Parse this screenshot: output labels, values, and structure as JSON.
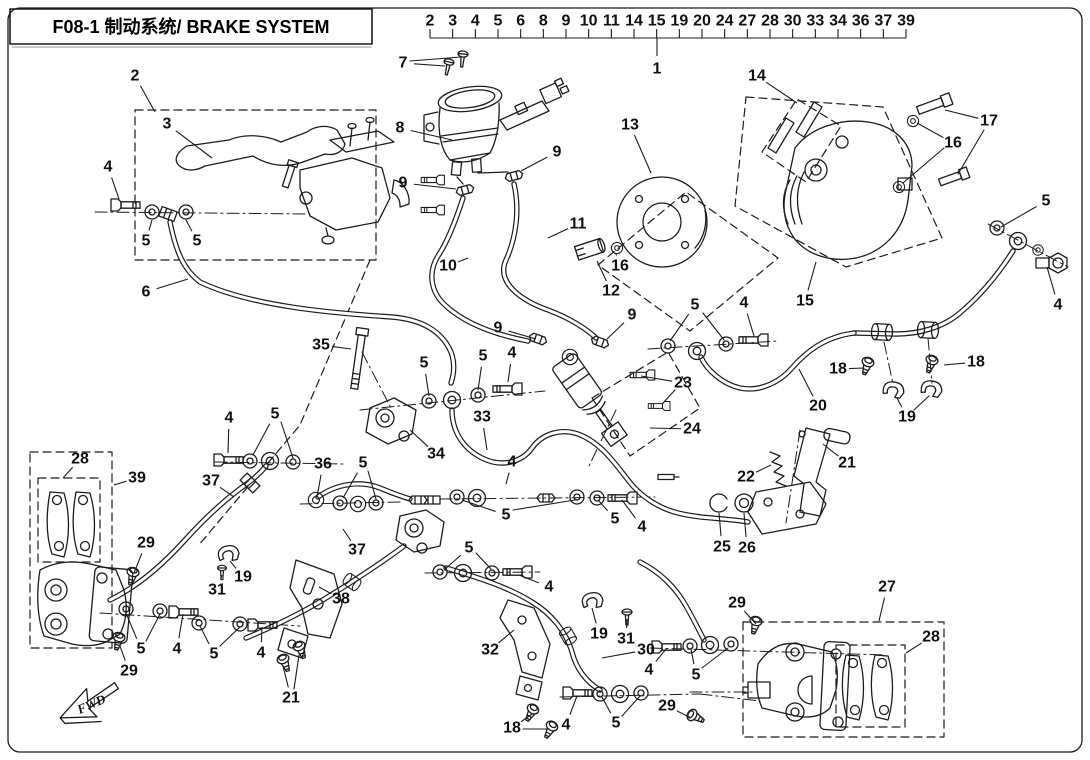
{
  "title": {
    "text": "F08-1 制动系统/ BRAKE SYSTEM"
  },
  "header": {
    "numbers": [
      "2",
      "3",
      "4",
      "5",
      "6",
      "8",
      "9",
      "10",
      "11",
      "14",
      "15",
      "19",
      "20",
      "24",
      "27",
      "28",
      "30",
      "33",
      "34",
      "36",
      "37",
      "39"
    ],
    "assembly_label": "1"
  },
  "fwd_label": "FWD",
  "colors": {
    "line": "#1c1c1c",
    "background": "#ffffff"
  },
  "callouts": [
    {
      "n": "2",
      "x": 135,
      "y": 76,
      "tx": 155,
      "ty": 112
    },
    {
      "n": "3",
      "x": 167,
      "y": 124,
      "tx": 212,
      "ty": 158
    },
    {
      "n": "4",
      "x": 108,
      "y": 167,
      "tx": 119,
      "ty": 199
    },
    {
      "n": "5",
      "x": 146,
      "y": 241,
      "tx": 152,
      "ty": 220
    },
    {
      "n": "5",
      "x": 197,
      "y": 241,
      "tx": 186,
      "ty": 220
    },
    {
      "n": "6",
      "x": 146,
      "y": 292,
      "tx": 188,
      "ty": 279
    },
    {
      "n": "7",
      "x": 403,
      "y": 63,
      "tx": 445,
      "ty": 66
    },
    {
      "n": "8",
      "x": 400,
      "y": 128,
      "tx": 452,
      "ty": 140
    },
    {
      "n": "9",
      "x": 557,
      "y": 152,
      "tx": 521,
      "ty": 171
    },
    {
      "n": "9",
      "x": 403,
      "y": 183,
      "tx": 456,
      "ty": 189
    },
    {
      "n": "10",
      "x": 448,
      "y": 266,
      "tx": 468,
      "ty": 258
    },
    {
      "n": "11",
      "x": 578,
      "y": 224,
      "tx": 548,
      "ty": 238
    },
    {
      "n": "12",
      "x": 611,
      "y": 291,
      "tx": 597,
      "ty": 261
    },
    {
      "n": "13",
      "x": 630,
      "y": 125,
      "tx": 651,
      "ty": 173
    },
    {
      "n": "16",
      "x": 620,
      "y": 266,
      "tx": 616,
      "ty": 254
    },
    {
      "n": "14",
      "x": 757,
      "y": 76,
      "tx": 797,
      "ty": 103
    },
    {
      "n": "17",
      "x": 989,
      "y": 121,
      "tx": 945,
      "ty": 110
    },
    {
      "n": "16",
      "x": 953,
      "y": 143,
      "tx": 917,
      "ty": 123
    },
    {
      "n": "15",
      "x": 805,
      "y": 301,
      "tx": 816,
      "ty": 262
    },
    {
      "n": "5",
      "x": 1046,
      "y": 201,
      "tx": 1001,
      "ty": 227
    },
    {
      "n": "4",
      "x": 1058,
      "y": 305,
      "tx": 1047,
      "ty": 267
    },
    {
      "n": "9",
      "x": 498,
      "y": 328,
      "tx": 536,
      "ty": 339
    },
    {
      "n": "9",
      "x": 632,
      "y": 315,
      "tx": 607,
      "ty": 339
    },
    {
      "n": "5",
      "x": 695,
      "y": 305,
      "tx": 670,
      "ty": 341
    },
    {
      "n": "4",
      "x": 744,
      "y": 303,
      "tx": 754,
      "ty": 336
    },
    {
      "n": "18",
      "x": 838,
      "y": 369,
      "tx": 864,
      "ty": 368
    },
    {
      "n": "18",
      "x": 976,
      "y": 362,
      "tx": 944,
      "ty": 365
    },
    {
      "n": "19",
      "x": 907,
      "y": 417,
      "tx": 897,
      "ty": 398
    },
    {
      "n": "20",
      "x": 818,
      "y": 406,
      "tx": 799,
      "ty": 369
    },
    {
      "n": "23",
      "x": 683,
      "y": 383,
      "tx": 641,
      "ty": 376
    },
    {
      "n": "24",
      "x": 692,
      "y": 429,
      "tx": 650,
      "ty": 428
    },
    {
      "n": "35",
      "x": 321,
      "y": 345,
      "tx": 351,
      "ty": 349
    },
    {
      "n": "5",
      "x": 424,
      "y": 363,
      "tx": 429,
      "ty": 396
    },
    {
      "n": "5",
      "x": 483,
      "y": 356,
      "tx": 478,
      "ty": 390
    },
    {
      "n": "4",
      "x": 512,
      "y": 353,
      "tx": 508,
      "ty": 382
    },
    {
      "n": "33",
      "x": 482,
      "y": 417,
      "tx": 487,
      "ty": 450
    },
    {
      "n": "34",
      "x": 436,
      "y": 454,
      "tx": 410,
      "ty": 430
    },
    {
      "n": "36",
      "x": 323,
      "y": 464,
      "tx": 317,
      "ty": 497
    },
    {
      "n": "5",
      "x": 363,
      "y": 463,
      "tx": 343,
      "ty": 498
    },
    {
      "n": "4",
      "x": 512,
      "y": 462,
      "tx": 506,
      "ty": 484
    },
    {
      "n": "21",
      "x": 847,
      "y": 463,
      "tx": 823,
      "ty": 444
    },
    {
      "n": "22",
      "x": 746,
      "y": 477,
      "tx": 771,
      "ty": 465
    },
    {
      "n": "25",
      "x": 722,
      "y": 547,
      "tx": 719,
      "ty": 513
    },
    {
      "n": "26",
      "x": 747,
      "y": 548,
      "tx": 744,
      "ty": 513
    },
    {
      "n": "5",
      "x": 615,
      "y": 519,
      "tx": 598,
      "ty": 500
    },
    {
      "n": "4",
      "x": 642,
      "y": 527,
      "tx": 622,
      "ty": 500
    },
    {
      "n": "28",
      "x": 80,
      "y": 459,
      "tx": 63,
      "ty": 478
    },
    {
      "n": "39",
      "x": 137,
      "y": 478,
      "tx": 114,
      "ty": 485
    },
    {
      "n": "37",
      "x": 211,
      "y": 481,
      "tx": 234,
      "ty": 497
    },
    {
      "n": "29",
      "x": 146,
      "y": 543,
      "tx": 134,
      "ty": 573
    },
    {
      "n": "19",
      "x": 243,
      "y": 577,
      "tx": 230,
      "ty": 561
    },
    {
      "n": "31",
      "x": 217,
      "y": 590,
      "tx": 222,
      "ty": 575
    },
    {
      "n": "37",
      "x": 357,
      "y": 550,
      "tx": 343,
      "ty": 529
    },
    {
      "n": "4",
      "x": 229,
      "y": 418,
      "tx": 228,
      "ty": 453
    },
    {
      "n": "5",
      "x": 275,
      "y": 414,
      "tx": 253,
      "ty": 455
    },
    {
      "n": "38",
      "x": 341,
      "y": 599,
      "tx": 319,
      "ty": 587
    },
    {
      "n": "5",
      "x": 141,
      "y": 649,
      "tx": 126,
      "ty": 613
    },
    {
      "n": "4",
      "x": 177,
      "y": 649,
      "tx": 183,
      "ty": 614
    },
    {
      "n": "5",
      "x": 214,
      "y": 654,
      "tx": 200,
      "ty": 626
    },
    {
      "n": "4",
      "x": 261,
      "y": 653,
      "tx": 262,
      "ty": 627
    },
    {
      "n": "29",
      "x": 129,
      "y": 671,
      "tx": 120,
      "ty": 646
    },
    {
      "n": "21",
      "x": 291,
      "y": 698,
      "tx": 283,
      "ty": 666
    },
    {
      "n": "4",
      "x": 549,
      "y": 587,
      "tx": 519,
      "ty": 575
    },
    {
      "n": "19",
      "x": 599,
      "y": 634,
      "tx": 592,
      "ty": 608
    },
    {
      "n": "31",
      "x": 626,
      "y": 639,
      "tx": 627,
      "ty": 619
    },
    {
      "n": "30",
      "x": 646,
      "y": 650,
      "tx": 602,
      "ty": 658
    },
    {
      "n": "32",
      "x": 490,
      "y": 650,
      "tx": 514,
      "ty": 630
    },
    {
      "n": "29",
      "x": 737,
      "y": 603,
      "tx": 756,
      "ty": 624
    },
    {
      "n": "4",
      "x": 649,
      "y": 670,
      "tx": 666,
      "ty": 649
    },
    {
      "n": "5",
      "x": 696,
      "y": 675,
      "tx": 691,
      "ty": 649
    },
    {
      "n": "4",
      "x": 566,
      "y": 725,
      "tx": 577,
      "ty": 696
    },
    {
      "n": "5",
      "x": 616,
      "y": 723,
      "tx": 602,
      "ty": 697
    },
    {
      "n": "18",
      "x": 512,
      "y": 728,
      "tx": 532,
      "ty": 714
    },
    {
      "n": "29",
      "x": 667,
      "y": 706,
      "tx": 691,
      "ty": 718
    },
    {
      "n": "27",
      "x": 887,
      "y": 587,
      "tx": 879,
      "ty": 621
    },
    {
      "n": "28",
      "x": 931,
      "y": 637,
      "tx": 906,
      "ty": 653
    },
    {
      "n": "5",
      "x": 506,
      "y": 515,
      "tx": 462,
      "ty": 500
    },
    {
      "n": "5",
      "x": 469,
      "y": 548,
      "tx": 444,
      "ty": 570
    }
  ]
}
